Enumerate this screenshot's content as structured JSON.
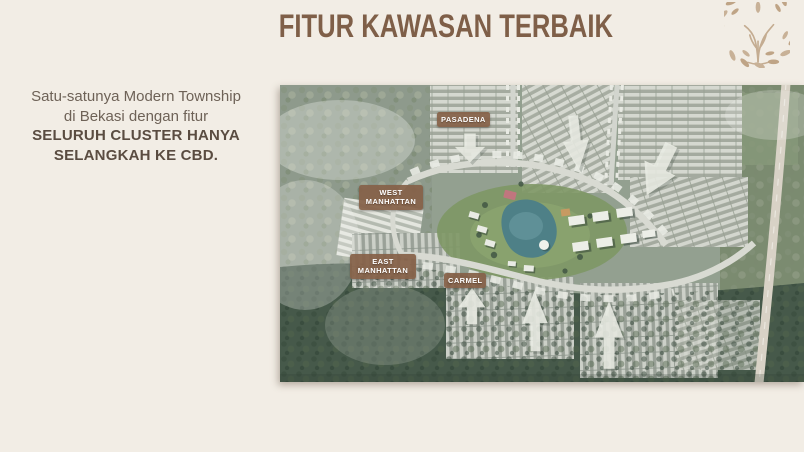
{
  "slide": {
    "title": "FITUR KAWASAN TERBAIK"
  },
  "intro": {
    "line1": "Satu-satunya Modern Township",
    "line2": "di Bekasi dengan fitur",
    "highlight1": "SELURUH CLUSTER HANYA",
    "highlight2": "SELANGKAH KE CBD."
  },
  "map": {
    "labels": {
      "pasadena": "PASADENA",
      "west_manhattan": "WEST MANHATTAN",
      "east_manhattan": "EAST MANHATTAN",
      "carmel": "CARMEL"
    }
  },
  "icons": {
    "brand_logo": "tree-icon",
    "map_arrow": "direction-arrow-icon"
  },
  "colors": {
    "background": "#f2ede5",
    "title": "#7f5f48",
    "body_text": "#6e6257",
    "highlight_text": "#5a4c41",
    "label_background": "#856249",
    "label_text": "#ffffff",
    "logo": "#c4ac91",
    "lake": "#4e8087",
    "arrow": "#e9ece4"
  }
}
